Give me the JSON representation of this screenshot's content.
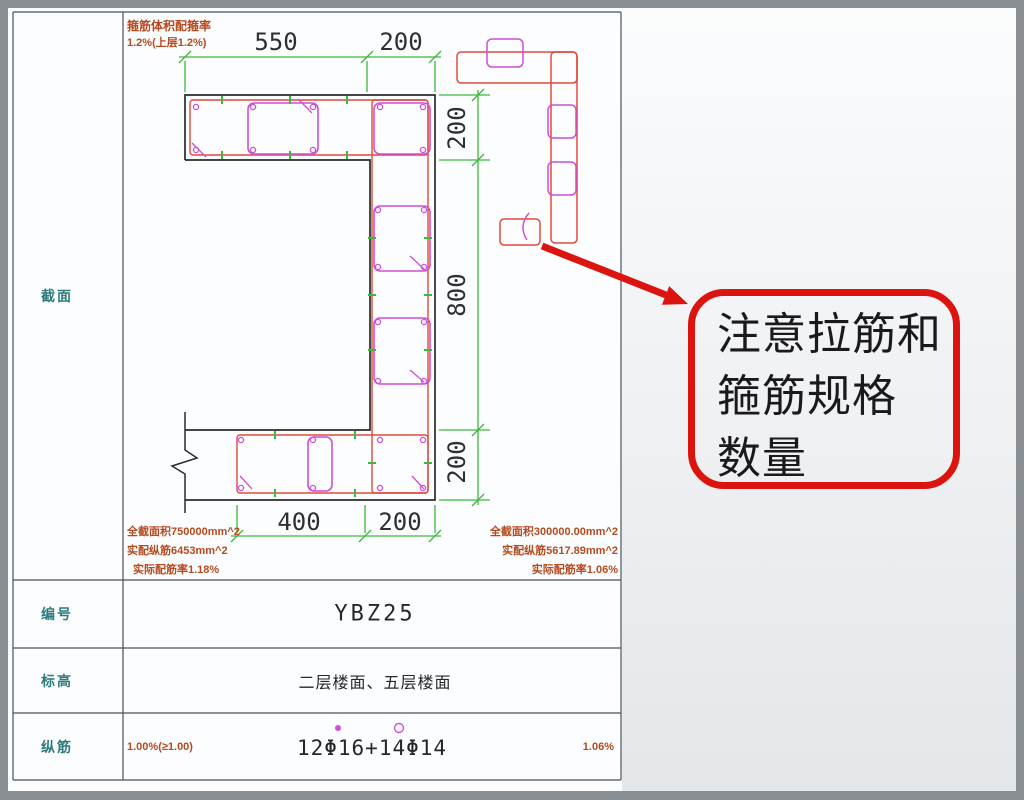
{
  "table": {
    "rows": [
      {
        "label": "截面"
      },
      {
        "label": "编号",
        "value": "YBZ25"
      },
      {
        "label": "标高",
        "value": "二层楼面、五层楼面"
      },
      {
        "label": "纵筋",
        "value": "12Φ16+14Φ14",
        "left_note": "1.00%(≥1.00)",
        "right_note": "1.06%"
      }
    ]
  },
  "drawing": {
    "dims": {
      "top_left": "550",
      "top_right": "200",
      "right_top": "200",
      "right_mid": "800",
      "right_bottom": "200",
      "bottom_left": "400",
      "bottom_right": "200"
    },
    "notes": {
      "top_left_1": "箍筋体积配箍率",
      "top_left_2": "1.2%(上层1.2%)",
      "bottom_left_1": "全截面积750000mm^2",
      "bottom_left_2": "实配纵筋6453mm^2",
      "bottom_left_3": "实际配筋率1.18%",
      "bottom_right_1": "全截面积300000.00mm^2",
      "bottom_right_2": "实配纵筋5617.89mm^2",
      "bottom_right_3": "实际配筋率1.06%"
    }
  },
  "callout": {
    "line1": "注意拉筋和",
    "line2": "箍筋规格",
    "line3": "数量"
  },
  "colors": {
    "concrete_outline": "#2b2b2b",
    "rebar_red": "#e0493b",
    "stirrup_magenta": "#cf4fd6",
    "dim_green": "#3cb93c",
    "note_red": "#b44a20",
    "label_teal": "#2f7b7c",
    "callout_red": "#dc1410",
    "table_line": "#46565c"
  }
}
